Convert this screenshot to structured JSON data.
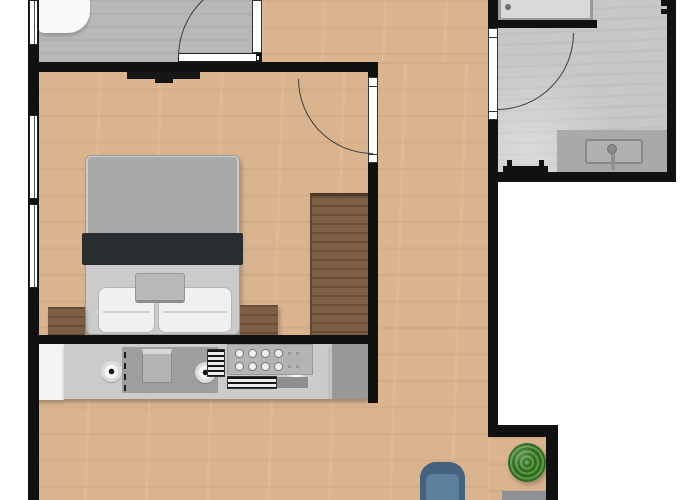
{
  "scene": {
    "type": "apartment-floor-plan",
    "rooms": [
      "entry-wc",
      "hallway",
      "bedroom",
      "bathroom",
      "living-area",
      "kitchenette"
    ],
    "text_visible_on_image": []
  },
  "palette": {
    "wall": "#111111",
    "wood": "#d9b48f",
    "entryFloor": "#b8b8b6",
    "bathFloor": "#c7c7c5",
    "counter": "#cbcbcb",
    "counterPanel": "#9e9e9e",
    "cabinetWhite": "#f3f3f1",
    "applianceDark": "#989898",
    "bedFrame": "#cbcbcb",
    "duvet": "#a6a9a7",
    "blanket": "#2a2d30",
    "pillow": "#f0f0f0",
    "trayGray": "#b8b8b8",
    "brown": "#7d5f45",
    "tvBlack": "#161616",
    "arcLine": "#3c3c3c",
    "chair": "#5d809d",
    "chairDark": "#44627e",
    "plantDark": "#2f6b22",
    "plantLight": "#5d9c43",
    "shower": "#d9d9d9",
    "showerFrame": "#9b9b9b",
    "vanity": "#a9a9a9",
    "sideTable": "#8e9294",
    "white": "#ffffff"
  },
  "labels": {
    "entry": "Entry / WC",
    "hallway": "Hallway",
    "bedroom": "Bedroom",
    "bathroom": "Bathroom",
    "living": "Living area",
    "kitchen": "Kitchenette",
    "toilet": "Toilet",
    "entryDoor": "Entry room door",
    "bedroomDoor": "Bedroom door",
    "bathroomDoor": "Bathroom door",
    "tv": "Wall-mounted TV",
    "bed": "Double bed",
    "pillowLeft": "Pillow",
    "pillowRight": "Pillow",
    "bedTray": "Bed tray",
    "nightstandLeft": "Nightstand",
    "nightstandRight": "Nightstand",
    "desk": "Desk / dresser",
    "window": "Window",
    "counter": "Kitchen counter",
    "cabinet": "Kitchen cabinet",
    "sink": "Kitchen sink",
    "stove": "Stove control panel",
    "burner": "Burner",
    "appliance": "Kitchen appliance",
    "shower": "Shower",
    "towelRadiator": "Towel radiator",
    "vanity": "Washbasin vanity",
    "faucet": "Faucet",
    "bathRadiator": "Radiator",
    "armchair": "Armchair",
    "plant": "Potted plant",
    "sideTable": "Side table"
  }
}
